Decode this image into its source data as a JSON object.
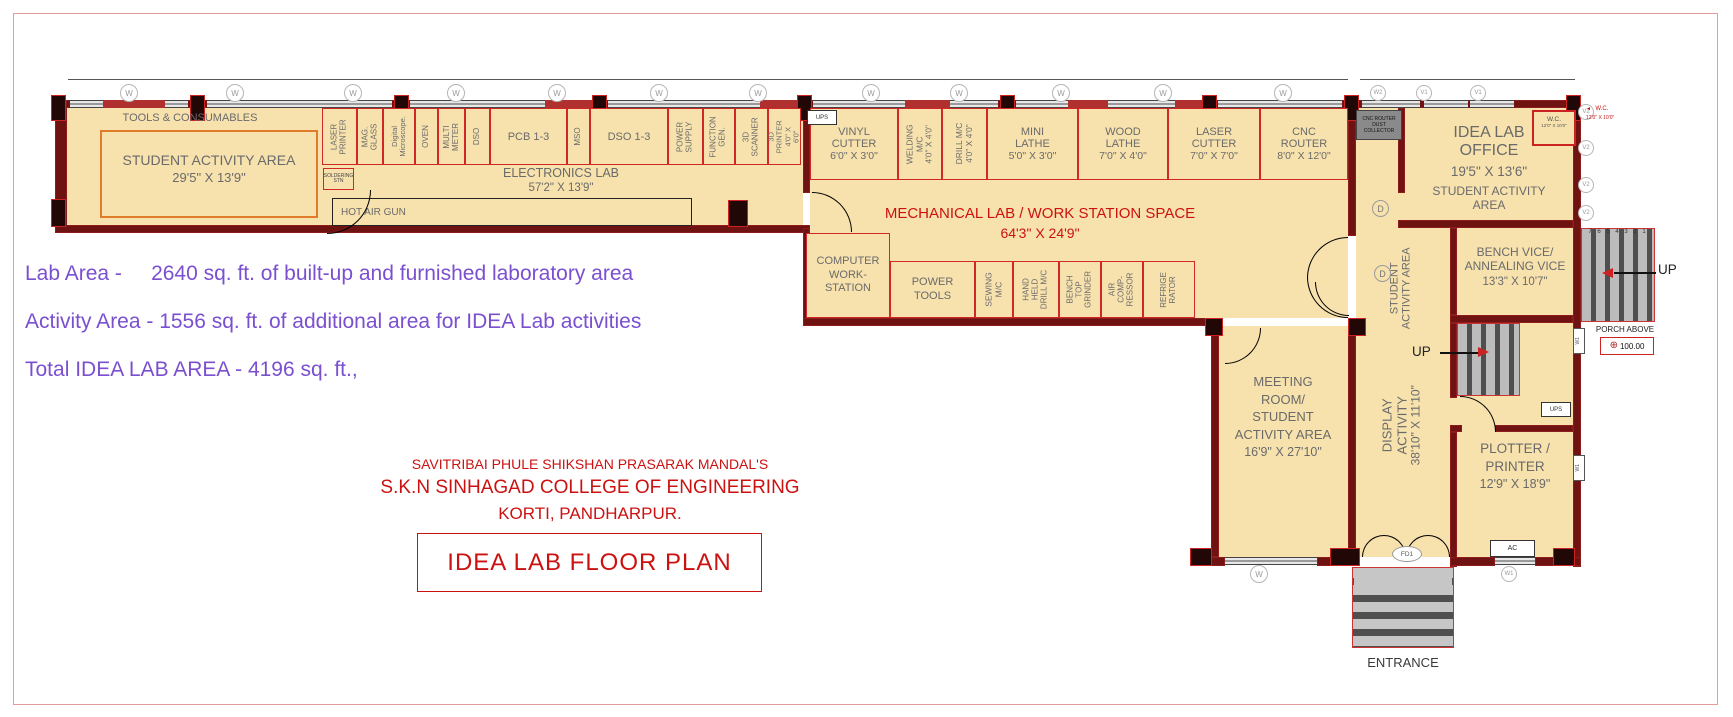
{
  "tools": {
    "label": "TOOLS & CONSUMABLES"
  },
  "student_nw": {
    "name": "STUDENT ACTIVITY AREA",
    "dim": "29'5\" X 13'9\""
  },
  "elec": {
    "name": "ELECTRONICS LAB",
    "dim": "57'2\" X 13'9\"",
    "soldering": "SOLDERING STN",
    "hot_air": "HOT AIR GUN",
    "ups": "UPS",
    "cells": [
      "LASER PRINTER",
      "MAG. GLASS",
      "Digital Microscope.",
      "OVEN",
      "MULTI METER",
      "DSO",
      "PCB 1-3",
      "MSO",
      "DSO 1-3",
      "POWER SUPPLY",
      "FUNCTION GEN.",
      "3D SCANNER"
    ],
    "printer3d": {
      "label": "3D PRINTER",
      "dim": "4'0\" X 6'0\""
    }
  },
  "mech": {
    "name": "MECHANICAL LAB / WORK STATION SPACE",
    "dim": "64'3\" X 24'9\"",
    "top": [
      {
        "label": "VINYL CUTTER",
        "dim": "6'0\" X 3'0\""
      },
      {
        "label": "WELDING M/C",
        "dim": "4'0\" X 4'0\""
      },
      {
        "label": "DRILL M/C",
        "dim": "4'0\" X 4'0\""
      },
      {
        "label": "MINI LATHE",
        "dim": "5'0\" X 3'0\""
      },
      {
        "label": "WOOD LATHE",
        "dim": "7'0\" X 4'0\""
      },
      {
        "label": "LASER CUTTER",
        "dim": "7'0\" X 7'0\""
      },
      {
        "label": "CNC ROUTER",
        "dim": "8'0\" X 12'0\""
      }
    ],
    "bottom": [
      "COMPUTER WORK- STATION",
      "POWER TOOLS",
      "SEWING M/C",
      "HAND HELD DRILL M/C",
      "BENCH TOP GRINDER",
      "AIR COMP- RESSOR",
      "REFRIGE RATOR"
    ]
  },
  "dust": "CNC ROUTER DUST COLLECTOR",
  "office": {
    "name": "IDEA LAB OFFICE",
    "dim": "19'5\" X 13'6\"",
    "sub": "STUDENT ACTIVITY AREA"
  },
  "wc": {
    "name": "W.C.",
    "dim": "12'0\" X 10'0\""
  },
  "corridor": {
    "student": "STUDENT ACTIVITY AREA",
    "display": "DISPLAY ACTIVITY",
    "display_dim": "38'10\" X 11'10\""
  },
  "bench": {
    "name": "BENCH VICE/ ANNEALING VICE",
    "dim": "13'3\" X 10'7\""
  },
  "meeting": {
    "name": "MEETING ROOM/ STUDENT ACTIVITY AREA",
    "dim": "16'9\" X 27'10\""
  },
  "plotter": {
    "name": "PLOTTER / PRINTER",
    "dim": "12'9\" X 18'9\"",
    "ups": "UPS",
    "ac": "AC"
  },
  "stairs": {
    "up": "UP",
    "numbers": "7 6 5 4 3 2 1",
    "porch": "PORCH ABOVE",
    "level": "100.00",
    "fd": "FD1",
    "entrance": "ENTRANCE"
  },
  "markers": {
    "w": "W",
    "w1": "W1",
    "w2": "W2",
    "v1": "V1",
    "v2": "V2",
    "d": "D"
  },
  "icons": {
    "wc_arrow": "◄",
    "level_glyph": "⊕"
  },
  "notes": {
    "line1": "Lab Area -     2640 sq. ft. of built-up and furnished laboratory area",
    "line2": "Activity Area - 1556 sq. ft. of additional area for IDEA Lab activities",
    "line3": "Total IDEA LAB AREA - 4196 sq. ft.,"
  },
  "title": {
    "org": "SAVITRIBAI PHULE SHIKSHAN PRASARAK MANDAL'S",
    "college": "S.K.N SINHAGAD COLLEGE OF ENGINEERING",
    "city": "KORTI, PANDHARPUR.",
    "plan": "IDEA LAB FLOOR PLAN"
  }
}
